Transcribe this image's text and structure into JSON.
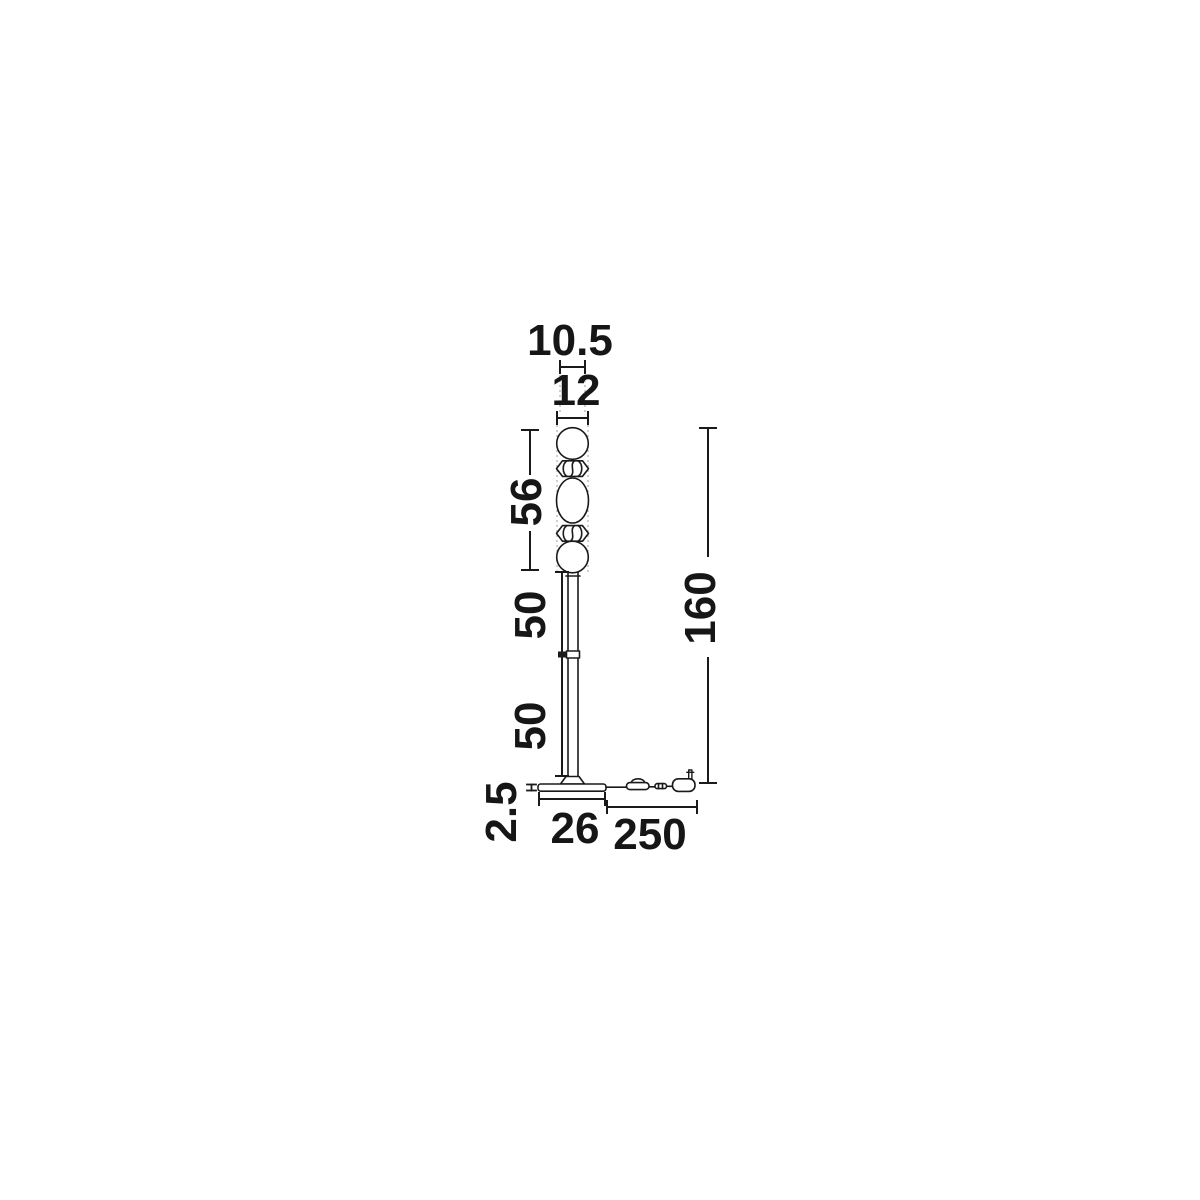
{
  "page": {
    "background": "#ffffff"
  },
  "diagram": {
    "type": "product-dimension-drawing",
    "subject": "floor lamp with stacked glass spheres, pole, base, cord switch and plug",
    "labels": {
      "top_sphere_diameter": "10.5",
      "shade_max_width": "12",
      "glass_stack_height": "56",
      "upper_pole_length": "50",
      "lower_pole_length": "50",
      "total_height": "160",
      "base_thickness": "2.5",
      "base_width": "26",
      "cable_length": "250"
    },
    "colors": {
      "line": "#1a1a1a",
      "guide": "#b3b3b3",
      "background": "#ffffff"
    }
  }
}
